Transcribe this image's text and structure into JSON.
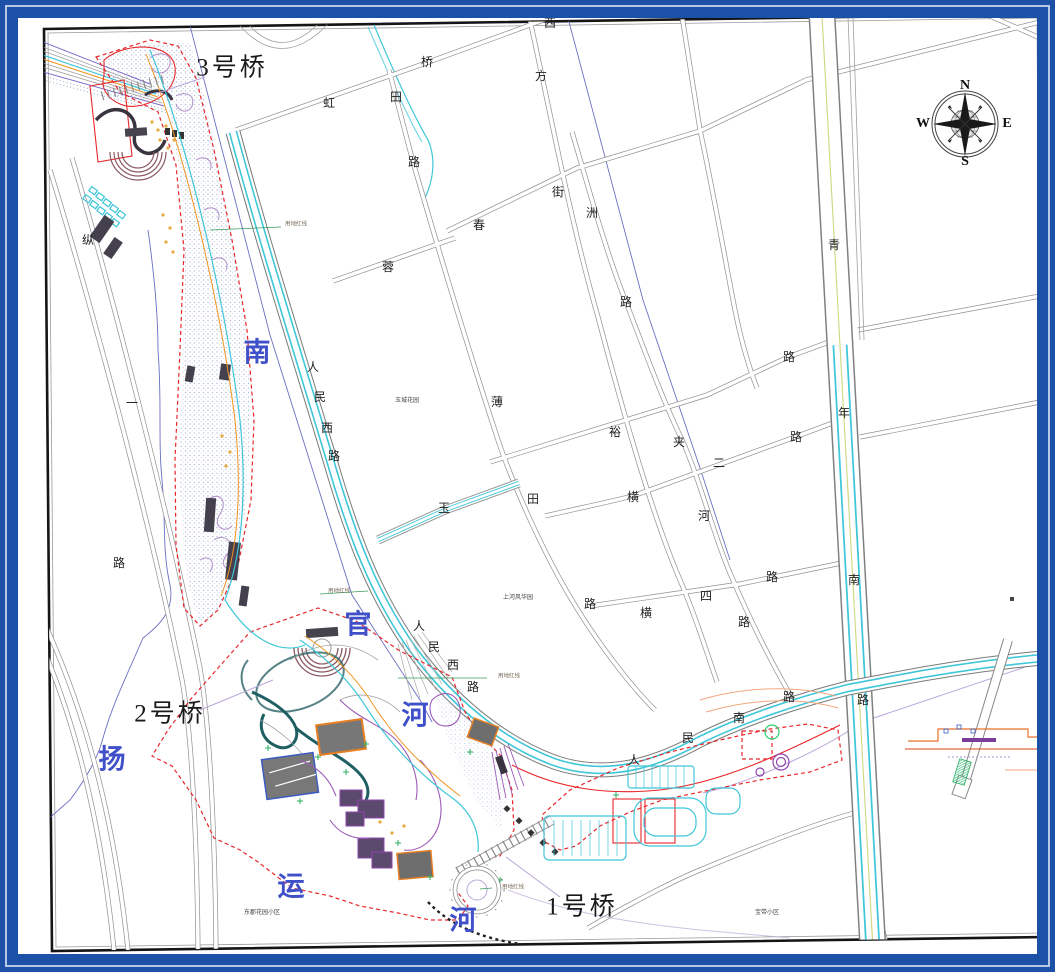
{
  "document": {
    "type": "site-plan-drawing",
    "border_colors": {
      "outer_blue": "#1d50a7",
      "light_band": "#b5c8e6",
      "frame_black": "#111111"
    },
    "palette": {
      "boundary_redline": "#e8262a",
      "road_cyan_edge": "#3fc6d8",
      "river_label_blue": "#4050c8",
      "water_texture": "#93a7cf",
      "orange_waterline": "#f0941e"
    }
  },
  "compass": {
    "icon": "compass-rose-icon",
    "directions": [
      "N",
      "E",
      "S",
      "W"
    ]
  },
  "map_labels": [
    {
      "name": "bridge-3-label",
      "text": "3号桥",
      "x": 232,
      "y": 68,
      "cls": "bridge"
    },
    {
      "name": "bridge-2-label",
      "text": "2号桥",
      "x": 170,
      "y": 714,
      "cls": "bridge"
    },
    {
      "name": "bridge-1-label",
      "text": "1号桥",
      "x": 582,
      "y": 907,
      "cls": "bridge"
    },
    {
      "name": "river-label-nan",
      "text": "南",
      "x": 257,
      "y": 353,
      "cls": "river"
    },
    {
      "name": "river-label-guan",
      "text": "官",
      "x": 358,
      "y": 625,
      "cls": "river"
    },
    {
      "name": "river-label-he",
      "text": "河",
      "x": 415,
      "y": 716,
      "cls": "river"
    },
    {
      "name": "river-label-yang",
      "text": "扬",
      "x": 112,
      "y": 760,
      "cls": "river"
    },
    {
      "name": "river-label-yun",
      "text": "运",
      "x": 291,
      "y": 887,
      "cls": "river"
    },
    {
      "name": "river-label-he2",
      "text": "河",
      "x": 463,
      "y": 921,
      "cls": "river"
    },
    {
      "name": "road-char",
      "text": "西",
      "x": 550,
      "y": 23,
      "cls": "road"
    },
    {
      "name": "road-char",
      "text": "桥",
      "x": 427,
      "y": 62,
      "cls": "road"
    },
    {
      "name": "road-char",
      "text": "方",
      "x": 541,
      "y": 76,
      "cls": "road"
    },
    {
      "name": "road-char",
      "text": "虹",
      "x": 329,
      "y": 103,
      "cls": "road"
    },
    {
      "name": "road-char",
      "text": "田",
      "x": 396,
      "y": 97,
      "cls": "road"
    },
    {
      "name": "road-char",
      "text": "路",
      "x": 414,
      "y": 162,
      "cls": "road"
    },
    {
      "name": "road-char",
      "text": "街",
      "x": 558,
      "y": 192,
      "cls": "road"
    },
    {
      "name": "road-char",
      "text": "洲",
      "x": 592,
      "y": 213,
      "cls": "road"
    },
    {
      "name": "road-char",
      "text": "春",
      "x": 479,
      "y": 225,
      "cls": "road"
    },
    {
      "name": "road-char",
      "text": "青",
      "x": 834,
      "y": 245,
      "cls": "road"
    },
    {
      "name": "road-char",
      "text": "蓉",
      "x": 388,
      "y": 267,
      "cls": "road"
    },
    {
      "name": "road-char",
      "text": "路",
      "x": 626,
      "y": 302,
      "cls": "road"
    },
    {
      "name": "road-char",
      "text": "纵",
      "x": 88,
      "y": 240,
      "cls": "road"
    },
    {
      "name": "road-char",
      "text": "一",
      "x": 132,
      "y": 403,
      "cls": "road"
    },
    {
      "name": "road-char",
      "text": "路",
      "x": 119,
      "y": 563,
      "cls": "road"
    },
    {
      "name": "road-char",
      "text": "路",
      "x": 789,
      "y": 357,
      "cls": "road"
    },
    {
      "name": "road-char",
      "text": "年",
      "x": 844,
      "y": 413,
      "cls": "road"
    },
    {
      "name": "road-char",
      "text": "薄",
      "x": 497,
      "y": 402,
      "cls": "road"
    },
    {
      "name": "road-char",
      "text": "裕",
      "x": 615,
      "y": 432,
      "cls": "road"
    },
    {
      "name": "road-char",
      "text": "夹",
      "x": 679,
      "y": 442,
      "cls": "road"
    },
    {
      "name": "road-char",
      "text": "路",
      "x": 796,
      "y": 437,
      "cls": "road"
    },
    {
      "name": "road-char",
      "text": "二",
      "x": 719,
      "y": 463,
      "cls": "road"
    },
    {
      "name": "road-char",
      "text": "玉",
      "x": 444,
      "y": 508,
      "cls": "road"
    },
    {
      "name": "road-char",
      "text": "田",
      "x": 533,
      "y": 499,
      "cls": "road"
    },
    {
      "name": "road-char",
      "text": "横",
      "x": 633,
      "y": 497,
      "cls": "road"
    },
    {
      "name": "road-char",
      "text": "河",
      "x": 704,
      "y": 516,
      "cls": "road"
    },
    {
      "name": "road-char",
      "text": "南",
      "x": 854,
      "y": 580,
      "cls": "road"
    },
    {
      "name": "road-char",
      "text": "路",
      "x": 590,
      "y": 604,
      "cls": "road"
    },
    {
      "name": "road-char",
      "text": "路",
      "x": 772,
      "y": 577,
      "cls": "road"
    },
    {
      "name": "road-char",
      "text": "横",
      "x": 646,
      "y": 613,
      "cls": "road"
    },
    {
      "name": "road-char",
      "text": "四",
      "x": 706,
      "y": 596,
      "cls": "road"
    },
    {
      "name": "road-char",
      "text": "路",
      "x": 744,
      "y": 622,
      "cls": "road"
    },
    {
      "name": "road-char",
      "text": "路",
      "x": 863,
      "y": 700,
      "cls": "road"
    },
    {
      "name": "road-char",
      "text": "人",
      "x": 313,
      "y": 367,
      "cls": "road"
    },
    {
      "name": "road-char",
      "text": "民",
      "x": 320,
      "y": 397,
      "cls": "road"
    },
    {
      "name": "road-char",
      "text": "西",
      "x": 327,
      "y": 428,
      "cls": "road"
    },
    {
      "name": "road-char",
      "text": "路",
      "x": 334,
      "y": 456,
      "cls": "road"
    },
    {
      "name": "road-char",
      "text": "人",
      "x": 419,
      "y": 626,
      "cls": "road"
    },
    {
      "name": "road-char",
      "text": "民",
      "x": 434,
      "y": 647,
      "cls": "road"
    },
    {
      "name": "road-char",
      "text": "西",
      "x": 453,
      "y": 665,
      "cls": "road"
    },
    {
      "name": "road-char",
      "text": "路",
      "x": 473,
      "y": 687,
      "cls": "road"
    },
    {
      "name": "road-char",
      "text": "人",
      "x": 634,
      "y": 760,
      "cls": "road"
    },
    {
      "name": "road-char",
      "text": "民",
      "x": 688,
      "y": 738,
      "cls": "road"
    },
    {
      "name": "road-char",
      "text": "南",
      "x": 739,
      "y": 718,
      "cls": "road"
    },
    {
      "name": "road-char",
      "text": "路",
      "x": 789,
      "y": 697,
      "cls": "road"
    },
    {
      "name": "area-label-yucheng",
      "text": "玉城花园",
      "x": 407,
      "y": 401,
      "cls": "tiny"
    },
    {
      "name": "area-label-shanghe",
      "text": "上河风华园",
      "x": 518,
      "y": 598,
      "cls": "tiny"
    },
    {
      "name": "area-label-dongjun",
      "text": "东郡花园小区",
      "x": 262,
      "y": 913,
      "cls": "tiny"
    },
    {
      "name": "area-label-baodai",
      "text": "宝带小区",
      "x": 767,
      "y": 913,
      "cls": "tiny"
    },
    {
      "name": "redline-label",
      "text": "用地红线",
      "x": 296,
      "y": 225,
      "cls": "redline"
    },
    {
      "name": "redline-label",
      "text": "用地红线",
      "x": 339,
      "y": 592,
      "cls": "redline"
    },
    {
      "name": "redline-label",
      "text": "用地红线",
      "x": 509,
      "y": 677,
      "cls": "redline"
    },
    {
      "name": "redline-label",
      "text": "用地红线",
      "x": 513,
      "y": 888,
      "cls": "redline"
    },
    {
      "name": "compass-n",
      "text": "N",
      "x": 965,
      "y": 86,
      "cls": "compass"
    },
    {
      "name": "compass-e",
      "text": "E",
      "x": 1007,
      "y": 124,
      "cls": "compass"
    },
    {
      "name": "compass-s",
      "text": "S",
      "x": 965,
      "y": 162,
      "cls": "compass"
    },
    {
      "name": "compass-w",
      "text": "W",
      "x": 923,
      "y": 124,
      "cls": "compass"
    }
  ]
}
